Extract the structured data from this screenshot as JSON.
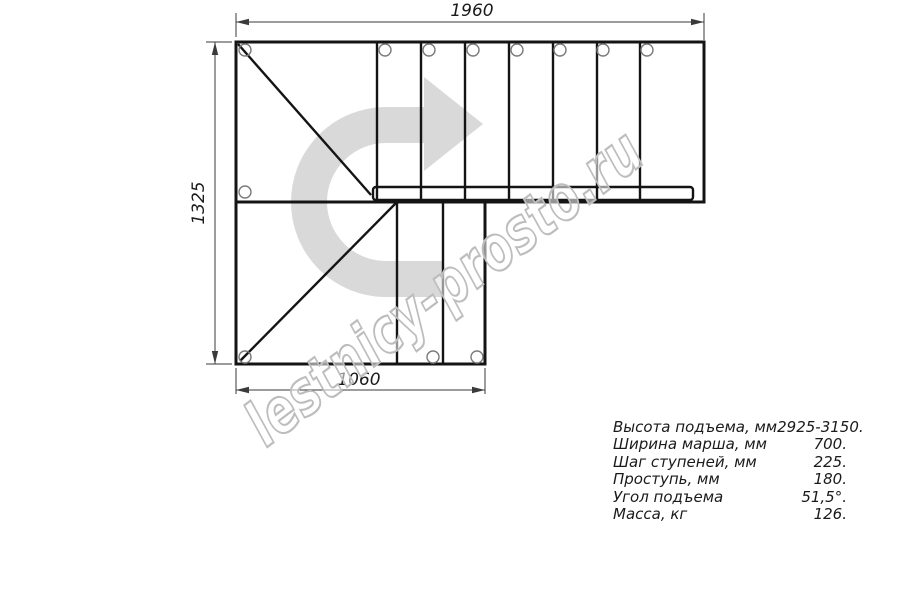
{
  "drawing": {
    "title": "L-shaped staircase plan view",
    "watermark": "lestnicy-prosto.ru",
    "dimensions": {
      "top": "1960",
      "left": "1325",
      "bottom": "1060"
    }
  },
  "specs": {
    "rows": [
      {
        "label": "Высота подъема, мм",
        "value": "2925-3150."
      },
      {
        "label": "Ширина марша, мм",
        "value": "700."
      },
      {
        "label": "Шаг ступеней, мм",
        "value": "225."
      },
      {
        "label": "Проступь, мм",
        "value": "180."
      },
      {
        "label": "Угол подъема",
        "value": "51,5°."
      },
      {
        "label": "Масса, кг",
        "value": "126."
      }
    ]
  },
  "colors": {
    "line": "#141414",
    "dimension_line": "#3a3a3a",
    "hole_outline": "#7a7a7a",
    "arrow_fill": "#d9d9d9",
    "watermark_stroke": "#bdbdbd",
    "background": "#ffffff"
  }
}
